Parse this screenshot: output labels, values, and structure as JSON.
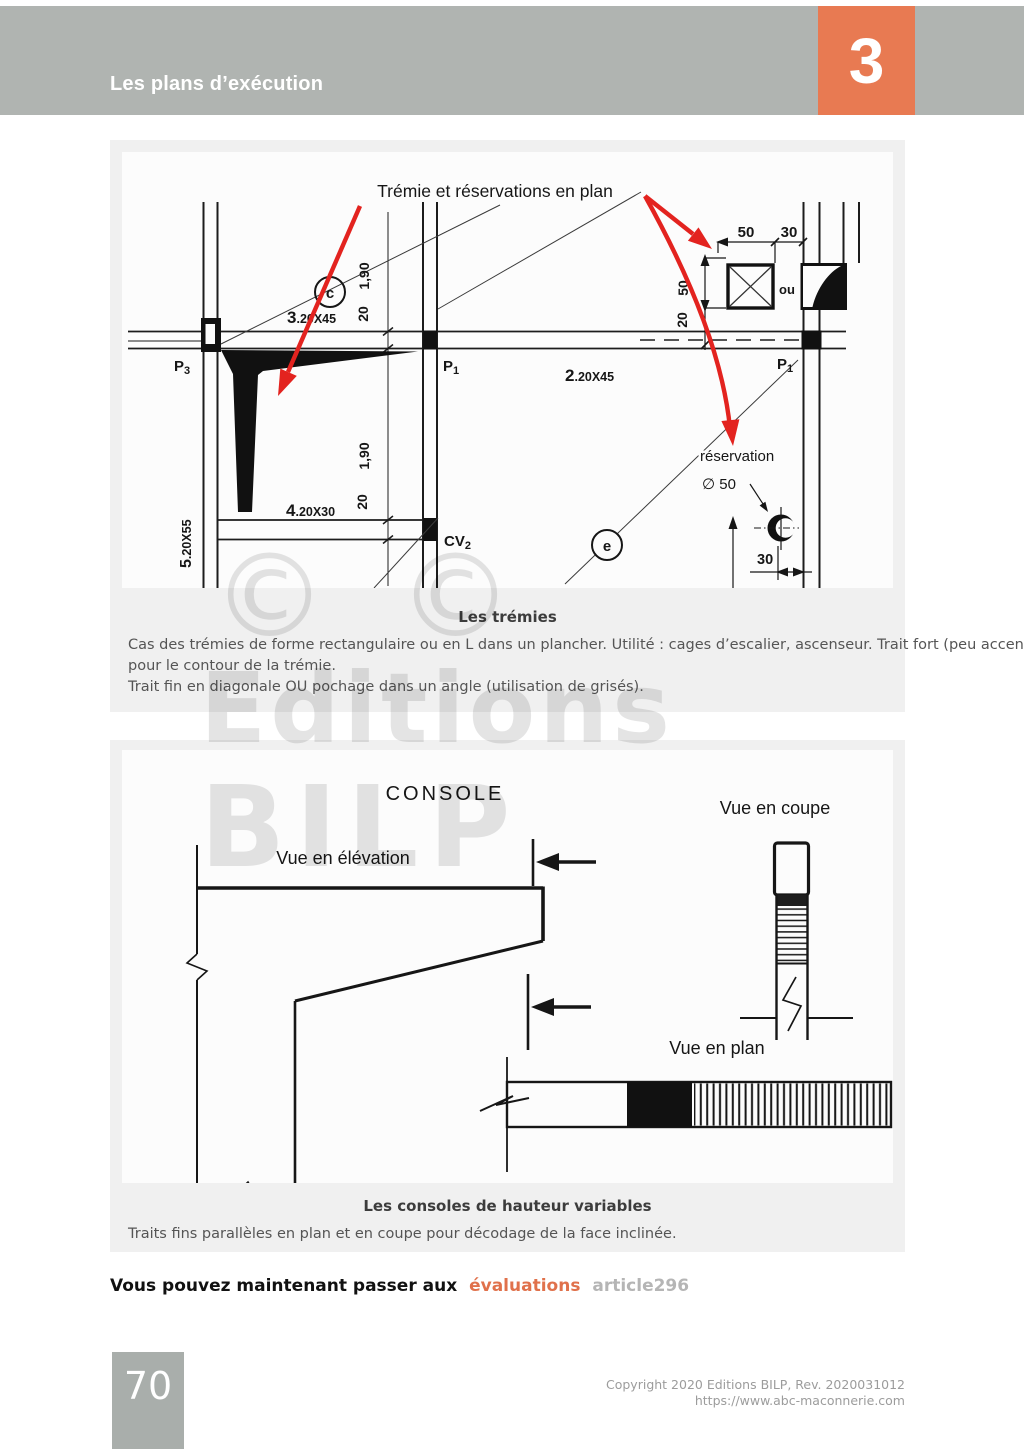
{
  "header": {
    "title": "Les plans d’exécution",
    "chapter": "3",
    "band_color": "#b0b4b1",
    "accent_color": "#e87a52"
  },
  "watermark": {
    "copyright_symbol": "©",
    "line1": "Editions",
    "line2": "BILP"
  },
  "figure1": {
    "title": "Trémie et réservations en plan",
    "bubbles": {
      "c": "c",
      "e": "e"
    },
    "beams": {
      "b3": {
        "num": "3",
        "size": ".20X45"
      },
      "b2": {
        "num": "2",
        "size": ".20X45"
      },
      "b4": {
        "num": "4",
        "size": ".20X30"
      },
      "b5": {
        "num": "5",
        "size": ".20X55"
      }
    },
    "piers": {
      "p3": {
        "label": "P",
        "sub": "3"
      },
      "p1_mid": {
        "label": "P",
        "sub": "1"
      },
      "p1_right": {
        "label": "P",
        "sub": "1"
      },
      "cv2": {
        "label": "CV",
        "sub": "2"
      }
    },
    "dims": {
      "d190_top": "1,90",
      "d20_top": "20",
      "d190_mid": "1,90",
      "d20_mid": "20",
      "d50_h": "50",
      "d30_h": "30",
      "d50_v": "50",
      "d20_v": "20",
      "d30_res": "30"
    },
    "reservation": {
      "label": "réservation",
      "diameter": "∅ 50"
    },
    "ou": "ou",
    "arrow_color": "#e3231f",
    "caption": {
      "title": "Les trémies",
      "lines": [
        "Cas des trémies de forme rectangulaire ou en L dans un plancher. Utilité : cages d’escalier, ascenseur. Trait fort (peu accentué),",
        "pour le contour de la trémie.",
        " Trait fin en diagonale OU pochage dans un angle (utilisation de grisés)."
      ]
    }
  },
  "figure2": {
    "title": "CONSOLE",
    "views": {
      "elevation": "Vue en élévation",
      "section": "Vue en coupe",
      "plan": "Vue en plan"
    },
    "caption": {
      "title": "Les consoles de hauteur variables",
      "lines": [
        "Traits fins parallèles en plan et en coupe pour décodage de la face inclinée."
      ]
    }
  },
  "cta": {
    "prefix": "Vous pouvez maintenant passer aux",
    "link": "évaluations",
    "suffix": "article296"
  },
  "footer": {
    "page_number": "70",
    "copyright": "Copyright 2020 Editions BILP, Rev. 2020031012",
    "url": "https://www.abc-maconnerie.com"
  }
}
